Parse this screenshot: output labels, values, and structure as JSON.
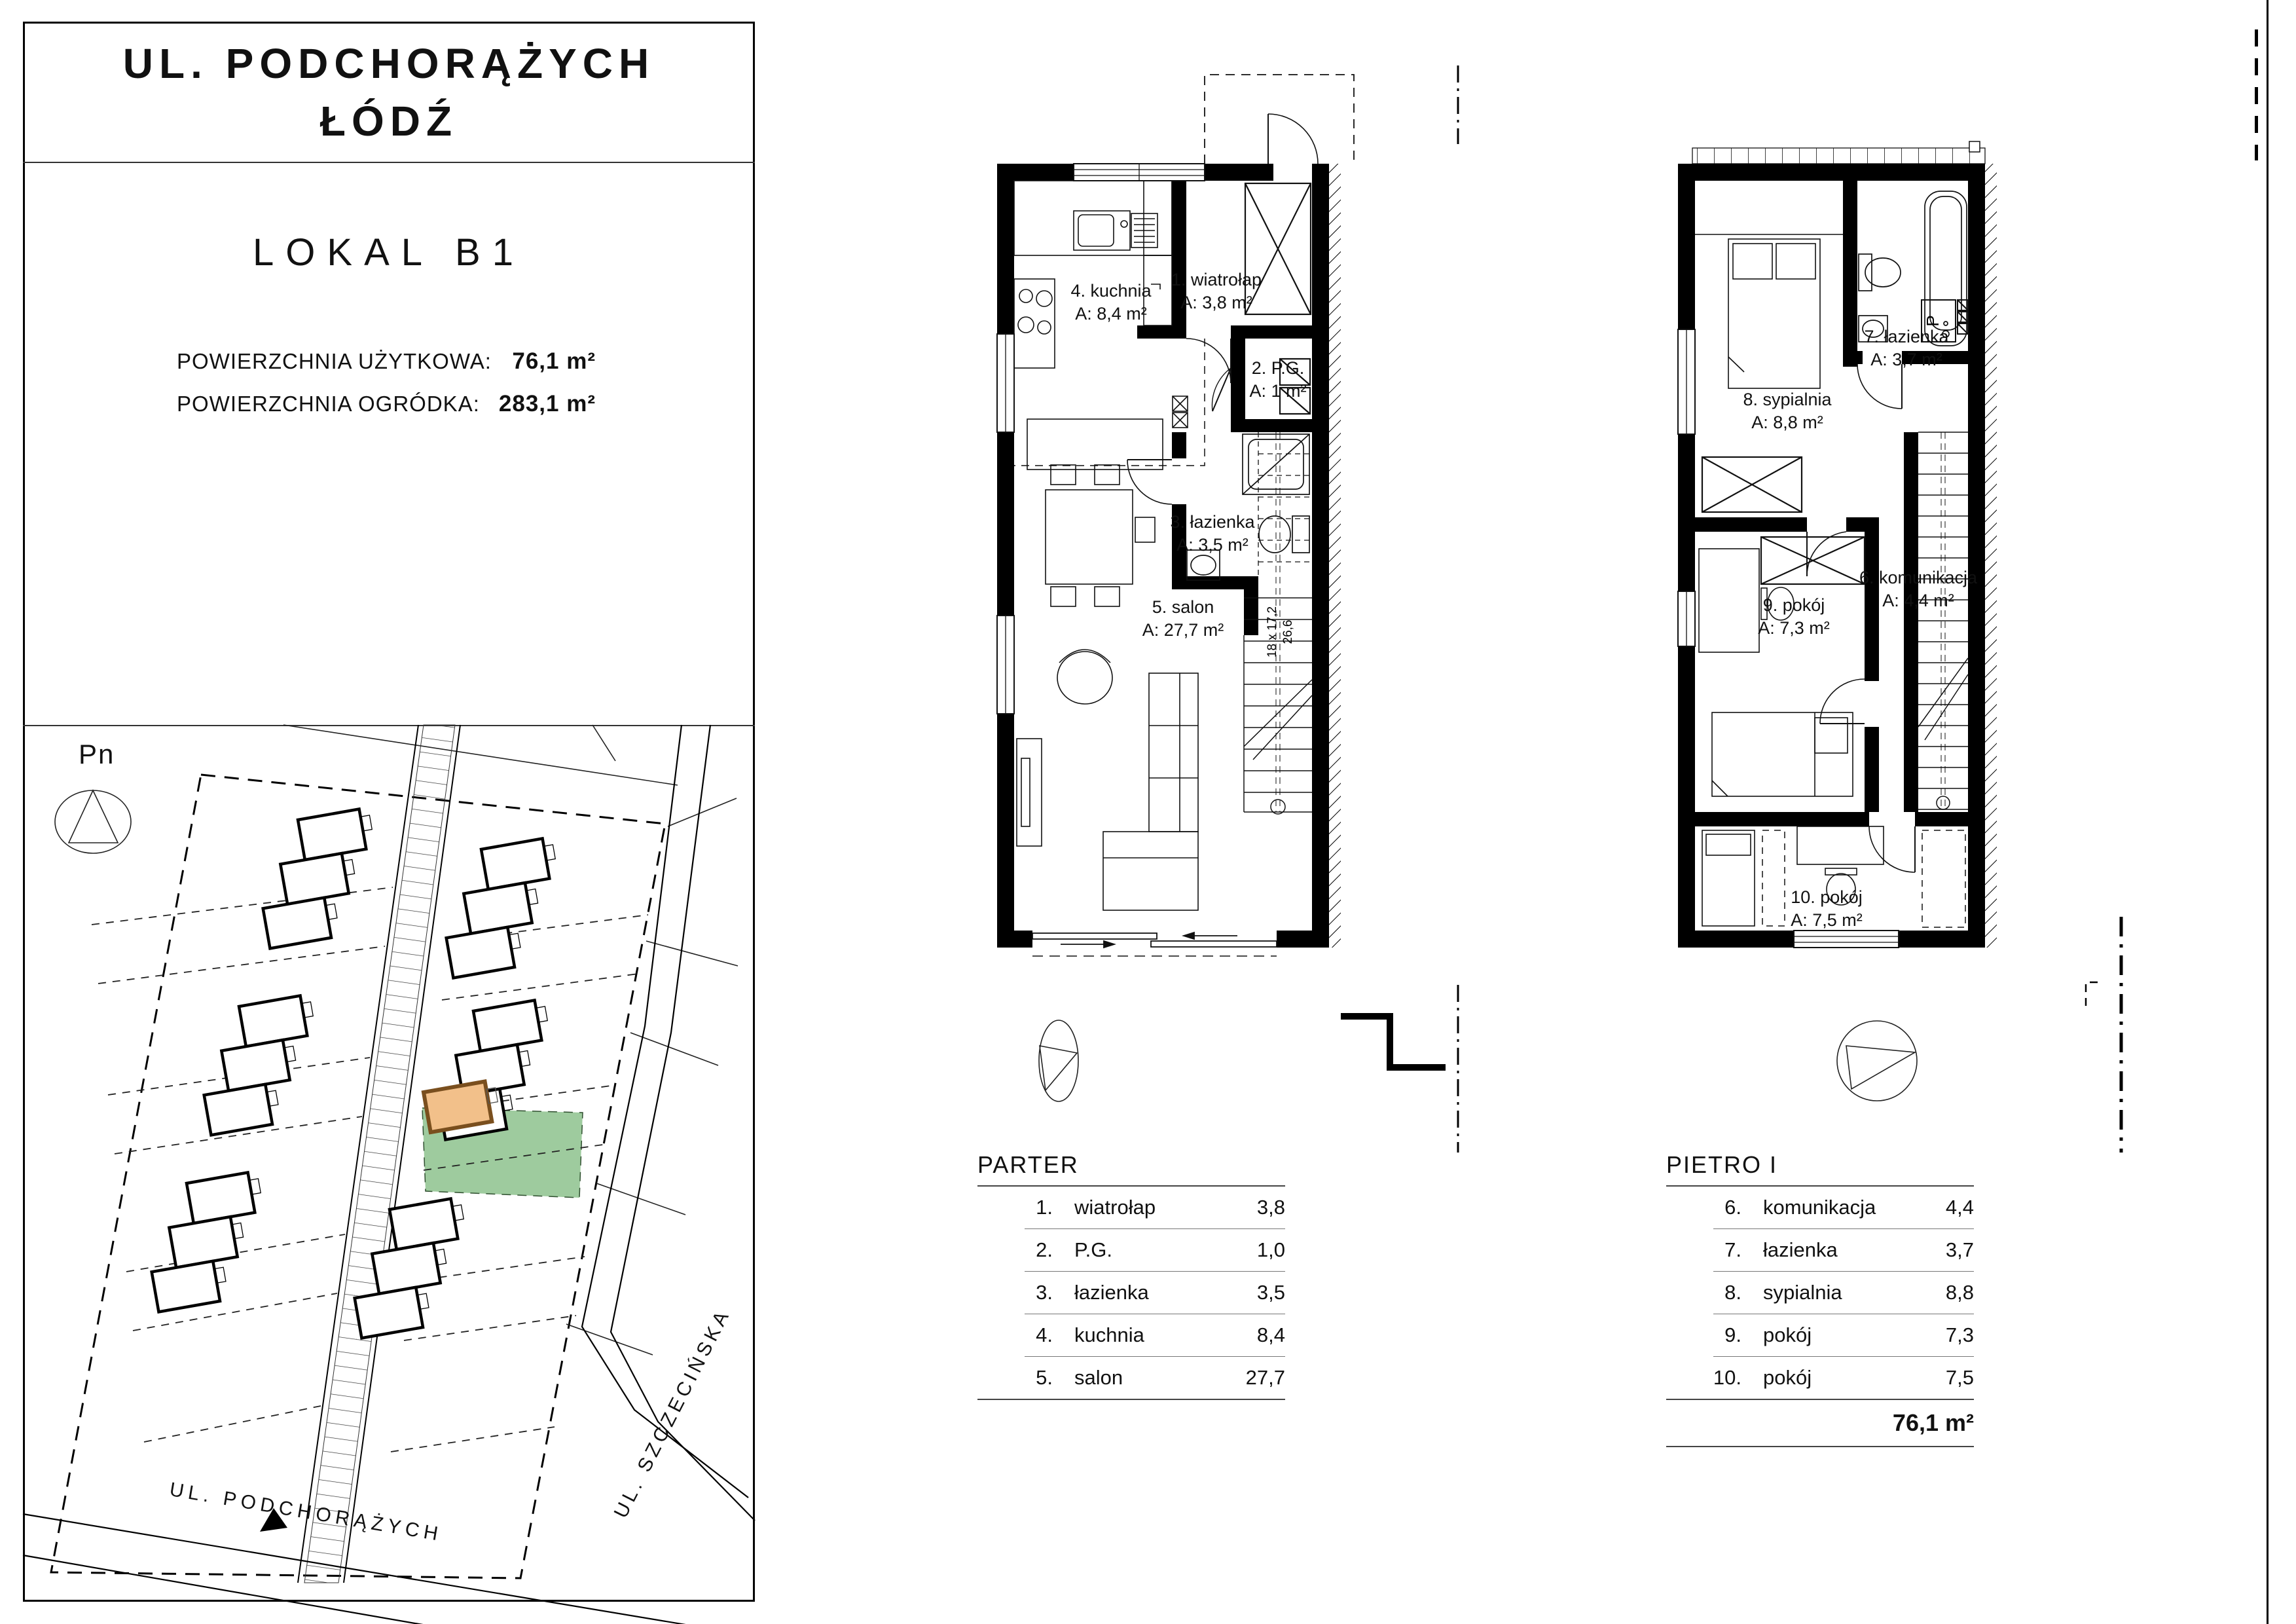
{
  "panel": {
    "street_title_line1": "UL. PODCHORĄŻYCH",
    "street_title_line2": "ŁÓDŹ",
    "unit_title": "LOKAL B1",
    "usable_area_label": "POWIERZCHNIA UŻYTKOWA:",
    "usable_area_value": "76,1 m²",
    "garden_area_label": "POWIERZCHNIA OGRÓDKA:",
    "garden_area_value": "283,1 m²"
  },
  "site_plan": {
    "north_label": "Pn",
    "street_bottom_label": "UL. PODCHORĄŻYCH",
    "street_right_label": "UL. SZCZECIŃSKA",
    "highlight_unit_color": "#f2c08a",
    "highlight_garden_color": "#94c594"
  },
  "floor_plans": {
    "parter": {
      "rooms": [
        {
          "name": "4. kuchnia",
          "area": "A: 8,4 m²"
        },
        {
          "name": "1. wiatrołap",
          "area": "A: 3,8 m²"
        },
        {
          "name": "2. P.G.",
          "area": "A: 1 m²"
        },
        {
          "name": "3. łazienka",
          "area": "A: 3,5 m²"
        },
        {
          "name": "5. salon",
          "area": "A: 27,7 m²"
        }
      ],
      "stairs_riser_label": "18 x 17,2",
      "stairs_going_label": "26,6"
    },
    "pietro": {
      "rooms": [
        {
          "name": "8. sypialnia",
          "area": "A: 8,8 m²"
        },
        {
          "name": "7. łazienka",
          "area": "A: 3,7 m²"
        },
        {
          "name": "9. pokój",
          "area": "A: 7,3 m²"
        },
        {
          "name": "6. komunikacja",
          "area": "A: 4,4 m²"
        },
        {
          "name": "10. pokój",
          "area": "A: 7,5 m²"
        }
      ],
      "washer_label": "P"
    }
  },
  "tables": {
    "parter": {
      "title": "PARTER",
      "rows": [
        {
          "num": "1.",
          "name": "wiatrołap",
          "area": "3,8"
        },
        {
          "num": "2.",
          "name": "P.G.",
          "area": "1,0"
        },
        {
          "num": "3.",
          "name": "łazienka",
          "area": "3,5"
        },
        {
          "num": "4.",
          "name": "kuchnia",
          "area": "8,4"
        },
        {
          "num": "5.",
          "name": "salon",
          "area": "27,7"
        }
      ]
    },
    "pietro": {
      "title": "PIETRO I",
      "rows": [
        {
          "num": "6.",
          "name": "komunikacja",
          "area": "4,4"
        },
        {
          "num": "7.",
          "name": "łazienka",
          "area": "3,7"
        },
        {
          "num": "8.",
          "name": "sypialnia",
          "area": "8,8"
        },
        {
          "num": "9.",
          "name": "pokój",
          "area": "7,3"
        },
        {
          "num": "10.",
          "name": "pokój",
          "area": "7,5"
        }
      ],
      "total": "76,1 m²"
    }
  }
}
